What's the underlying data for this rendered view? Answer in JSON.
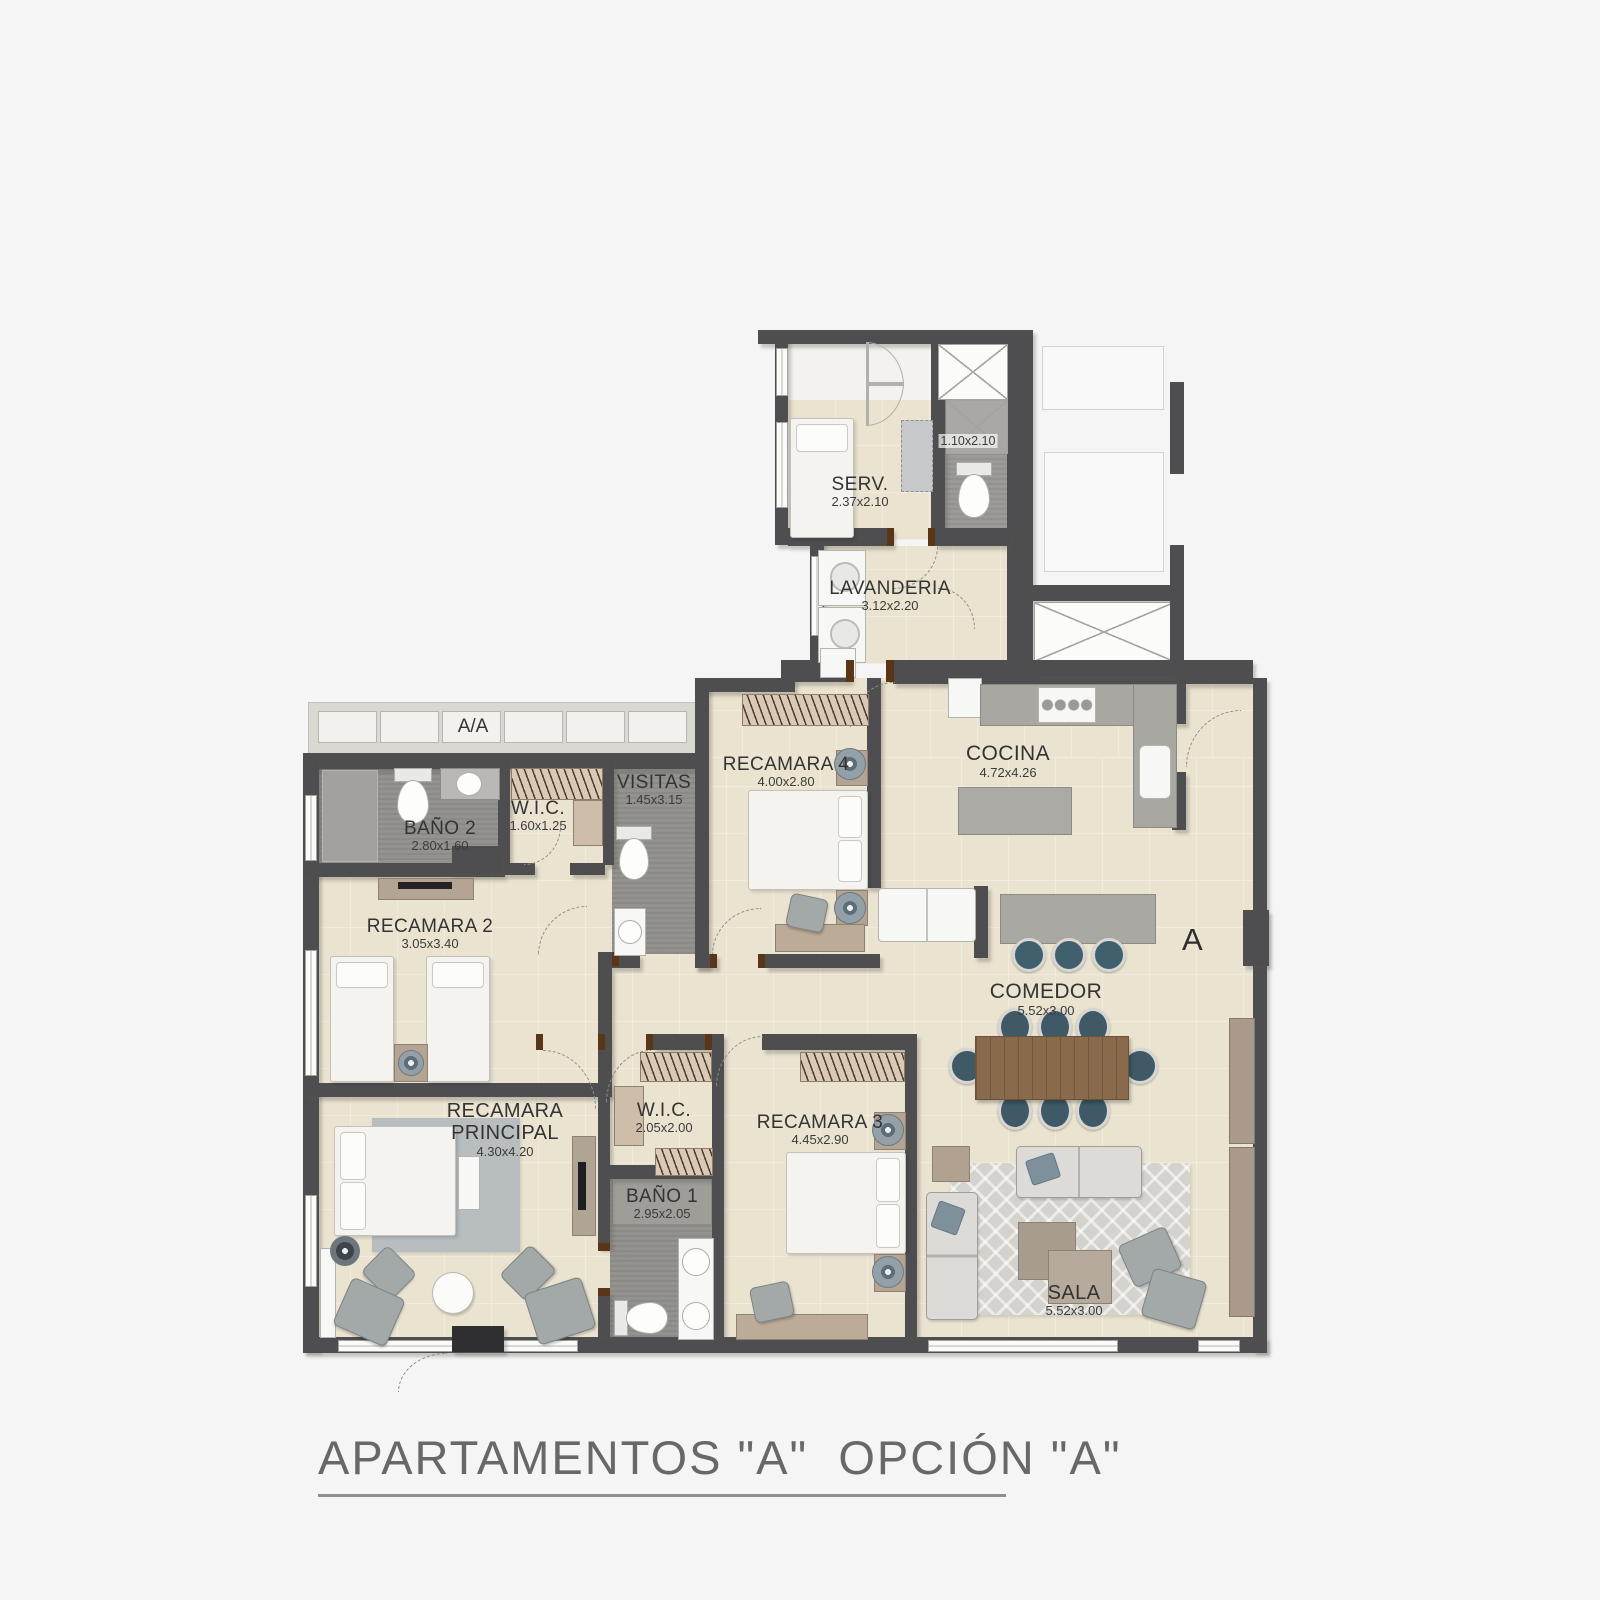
{
  "title": {
    "text": "APARTAMENTOS \"A\"  OPCIÓN \"A\""
  },
  "markers": {
    "ac_unit": "A/A",
    "section": "A"
  },
  "rooms": {
    "serv": {
      "name": "SERV.",
      "dims": "2.37x2.10"
    },
    "bano_aux": {
      "name": "",
      "dims": "1.10x2.10"
    },
    "lavanderia": {
      "name": "LAVANDERIA",
      "dims": "3.12x2.20"
    },
    "bano2": {
      "name": "BAÑO 2",
      "dims": "2.80x1.60"
    },
    "wic1": {
      "name": "W.I.C.",
      "dims": "1.60x1.25"
    },
    "visitas": {
      "name": "VISITAS",
      "dims": "1.45x3.15"
    },
    "recamara2": {
      "name": "RECAMARA 2",
      "dims": "3.05x3.40"
    },
    "recamara4": {
      "name": "RECAMARA 4",
      "dims": "4.00x2.80"
    },
    "cocina": {
      "name": "COCINA",
      "dims": "4.72x4.26"
    },
    "comedor": {
      "name": "COMEDOR",
      "dims": "5.52x3.00"
    },
    "rec_principal": {
      "name": "RECAMARA PRINCIPAL",
      "dims": "4.30x4.20"
    },
    "wic2": {
      "name": "W.I.C.",
      "dims": "2.05x2.00"
    },
    "bano1": {
      "name": "BAÑO 1",
      "dims": "2.95x2.05"
    },
    "recamara3": {
      "name": "RECAMARA 3",
      "dims": "4.45x2.90"
    },
    "sala": {
      "name": "SALA",
      "dims": "5.52x3.00"
    }
  },
  "colors": {
    "wall": "#4e4e50",
    "floor_beige": "#eae3d0",
    "floor_gray": "#93928e",
    "accent_wood": "#8a6a4c",
    "chair_teal": "#3f5a66",
    "background": "#f5f5f6"
  }
}
